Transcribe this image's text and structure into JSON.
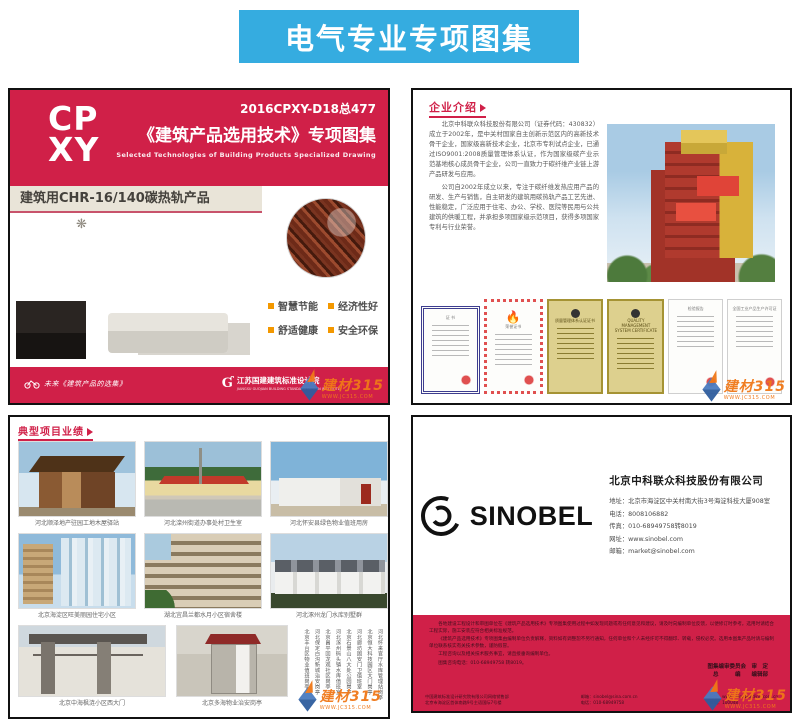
{
  "banner": {
    "title": "电气专业专项图集"
  },
  "cover": {
    "logo_top": "CP",
    "logo_bottom": "XY",
    "code": "2016CPXY-D18总477",
    "title": "《建筑产品选用技术》专项图集",
    "subtitle_en": "Selected Technologies of Building Products Specialized Drawing",
    "product_title": "建筑用CHR-16/140碳热轨产品",
    "features": [
      "智慧节能",
      "经济性好",
      "舒适健康",
      "安全环保"
    ],
    "footer_left": "未来《建筑产品的选集》",
    "footer_right_mark": "Ɠ",
    "footer_right_name": "江苏国建建筑标准设计院",
    "footer_right_sub": "JIANGSU GUOJIAN BUILDING STANDARD DESIGN INSTITUTE"
  },
  "intro": {
    "header": "企业介绍",
    "para1": "北京中科联众科技股份有限公司（证券代码：430832）成立于2002年，是中关村国家自主创新示范区内的高新技术骨干企业，国家级高新技术企业，北京市专利试点企业，已通过ISO9001:2008质量管理体系认证，作为国家级碳产业示范基地核心成员骨干企业，公司一直致力于碳纤维产业链上游产品研发与应用。",
    "para2": "公司自2002年成立以来，专注于碳纤维发热应用产品的研发、生产与销售，自主研发的建筑用碳热轨产品工艺先进、性能稳定，广泛应用于住宅、办公、学校、医院等民用与公共建筑的供暖工程，并承担多项国家级示范项目，获得多项国家专利与行业荣誉。",
    "certificates": [
      {
        "label": "证 书"
      },
      {
        "label": "荣誉证书"
      },
      {
        "label": "质量管理体系认证证书"
      },
      {
        "label": "QUALITY MANAGEMENT SYSTEM CERTIFICATE"
      },
      {
        "label": "检验报告"
      },
      {
        "label": "全国工业产品生产许可证"
      }
    ]
  },
  "projects": {
    "header": "典型项目业绩",
    "captions": [
      "河北顺泽地产驻园工地木屋驿站",
      "河北滦州街道办事处村卫生室",
      "河北怀安县绿色物业值班用房",
      "北京海淀区旺美丽园住宅小区",
      "湖北宜昌兰都水月小区宿舍楼",
      "河北涿州龙门水库别墅群",
      "北京中海枫涟小区西大门",
      "北京多海物业治安岗亭"
    ],
    "vertical_list": [
      "河北怀来官厅水库管理站岗亭",
      "北京恒大科技园区大门岗亭",
      "河北廊坊固安门卫值班室",
      "北京石景山八大处公园岗亭",
      "河北涿州码头镇水库值班室",
      "北京昌平回龙观社区岗亭",
      "河北保定白沟新城治安岗亭",
      "北京丰台区物业值班岗亭",
      "北京多海物业岗亭"
    ]
  },
  "backcover": {
    "logo_text": "SINOBEL",
    "company": "北京中科联众科技股份有限公司",
    "contact": [
      "地址：北京市海淀区中关村南大街3号海淀科技大厦908室",
      "电话：8008106882",
      "传真：010-68949758转8019",
      "网址：www.sinobel.com",
      "邮箱：market@sinobel.com"
    ],
    "band_para1": "各地建设工程设计和审图单位在《建筑产品选用技术》专项图集使用过程中如发现问题或有任何意见和建议，请及时向编制单位反馈，以便修订时参考。选用时请结合工程实际，施工安装应符合相关标准规范。",
    "band_para2": "《建筑产品选用技术》专项图集由编制单位负责解释，资料如有调整恕不另行通知，任何单位和个人未经许可不得翻印、转载，侵权必究。选用本图集产品时请与编制单位联系核实有关技术参数，谨防假冒。",
    "band_para3": "工程咨询以及相关技术服务事宜，请直接垂询编制单位。",
    "band_para4": "图集咨询电话：010-68949758 转8019。",
    "sign_line1": "图集编审委员会　审　定",
    "sign_line2": "总　　　编　　编辑部",
    "footer_cols": [
      "中国建筑标准设计研究院有限公司网络销售部\n北京市海淀区首体南路9号主语国际7号楼",
      "邮箱：sinobel@sina.com.cn\n电话：010-68949758",
      "网址：www.chinabuilding.com.cn\n邮编：100048"
    ]
  },
  "watermark": {
    "text": "建材315",
    "url": "WWW.JC315.COM"
  }
}
